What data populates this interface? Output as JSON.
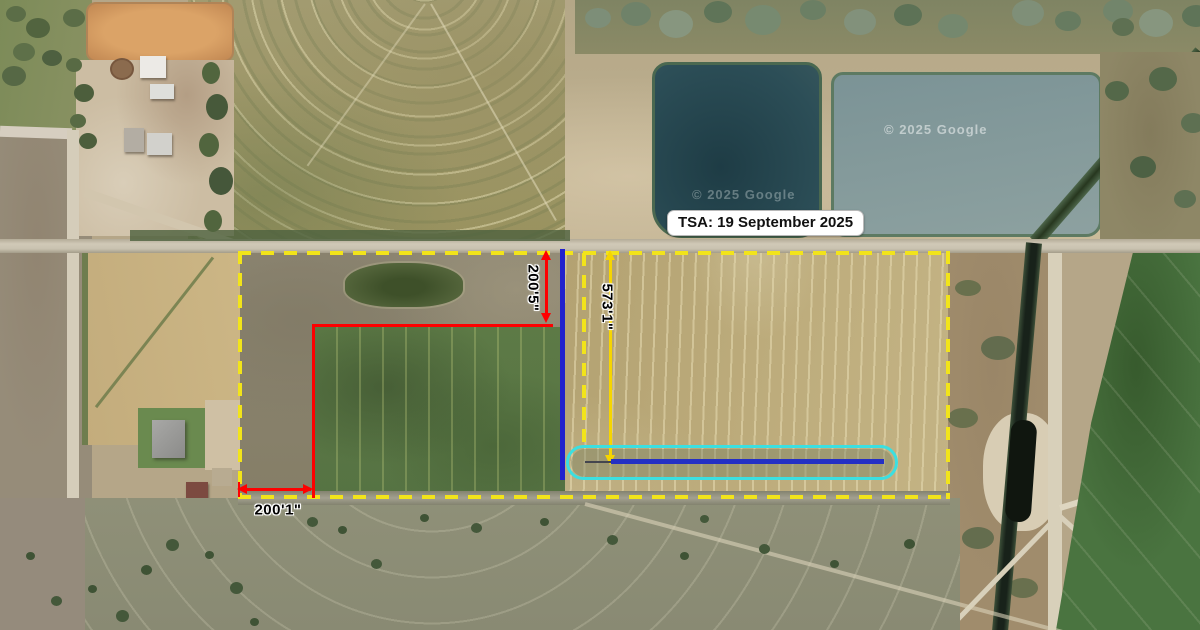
{
  "page": {
    "title": "Aerial parcel survey map",
    "width_px": 1200,
    "height_px": 630
  },
  "map": {
    "type": "satellite",
    "provider_watermarks": [
      {
        "text": "© 2025 Google"
      },
      {
        "text": "© 2025 Google"
      }
    ]
  },
  "callout": {
    "tsa_label": "TSA: 19 September 2025"
  },
  "measurements": {
    "north_offset": {
      "label": "200'5\"",
      "orientation": "vertical",
      "color_key": "measure-red"
    },
    "east_length": {
      "label": "573'1\"",
      "orientation": "vertical",
      "color_key": "measure-yellow"
    },
    "west_offset": {
      "label": "200'1\"",
      "orientation": "horizontal",
      "color_key": "measure-red"
    }
  },
  "legend_colors": {
    "boundary-yellow": "#f2e41a",
    "measure-red": "#fe0000",
    "survey-blue": "#2121cd",
    "bar-blue": "#2430c4",
    "buffer-cyan": "#3cdfe0",
    "measure-yellow": "#f6d500",
    "callout-bg": "#ffffff",
    "callout-text": "#111111"
  }
}
